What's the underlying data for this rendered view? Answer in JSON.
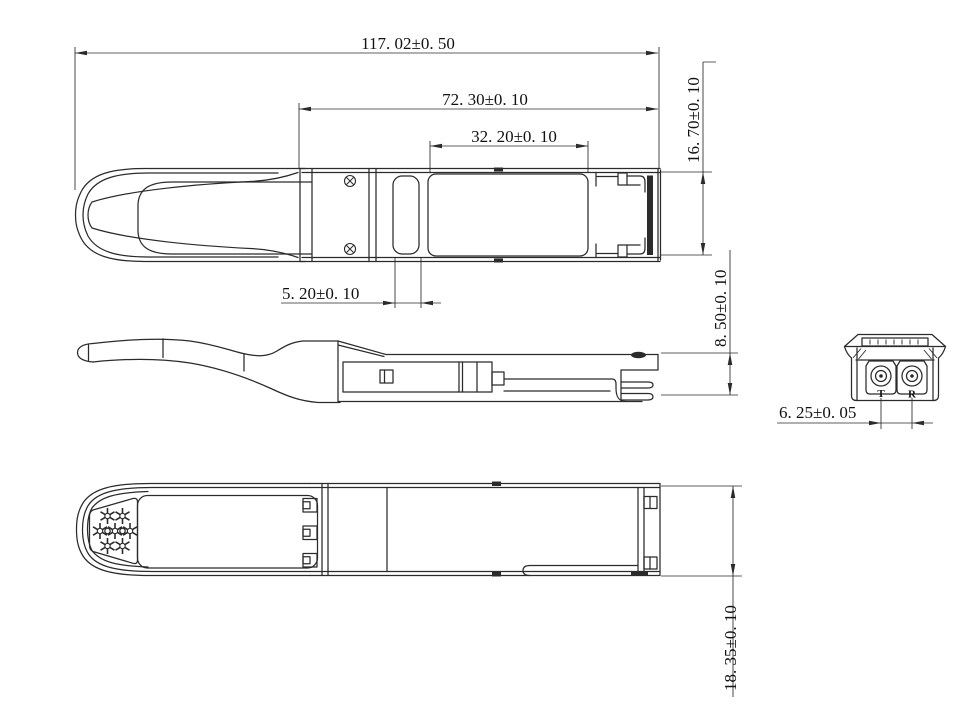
{
  "drawing": {
    "dims": {
      "overall_length": "117. 02±0. 50",
      "housing_length": "72. 30±0. 10",
      "label_window": "32. 20±0. 10",
      "latch_slot": "5. 20±0. 10",
      "end_width": "16. 70±0. 10",
      "rear_height": "8. 50±0. 10",
      "port_pitch": "6. 25±0. 05",
      "body_width": "18. 35±0. 10"
    },
    "ports": {
      "tx": "T",
      "rx": "R"
    },
    "colors": {
      "line": "#2b2b2b",
      "background": "#ffffff"
    }
  }
}
